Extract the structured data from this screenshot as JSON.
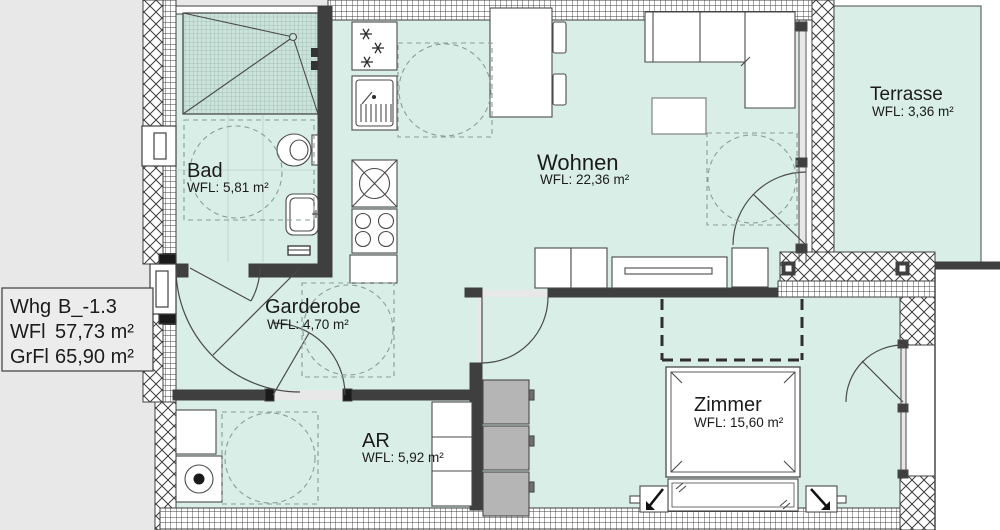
{
  "floorplan": {
    "title_box": {
      "unit_label": "Whg",
      "unit_value": "B_-1.3",
      "wfl_label": "WFl",
      "wfl_value": "57,73 m²",
      "grfl_label": "GrFl",
      "grfl_value": "65,90 m²"
    },
    "rooms": {
      "bad": {
        "name": "Bad",
        "area": "WFL: 5,81 m²"
      },
      "wohnen": {
        "name": "Wohnen",
        "area": "WFL: 22,36 m²"
      },
      "terrasse": {
        "name": "Terrasse",
        "area": "WFL: 3,36 m²"
      },
      "garderobe": {
        "name": "Garderobe",
        "area": "WFL: 4,70 m²"
      },
      "zimmer": {
        "name": "Zimmer",
        "area": "WFL: 15,60 m²"
      },
      "ar": {
        "name": "AR",
        "area": "WFL: 5,92 m²"
      }
    },
    "colors": {
      "floor": "#d8eee7",
      "outside": "#e8e8e8",
      "wall_dark": "#3f3f3f",
      "line": "#4a4a4a",
      "shower_tile": "#cbe3db",
      "furniture_fill": "#ffffff",
      "wardrobe_gray": "#b5b5b5",
      "turning_circle_dash": "#8c9c97"
    }
  }
}
